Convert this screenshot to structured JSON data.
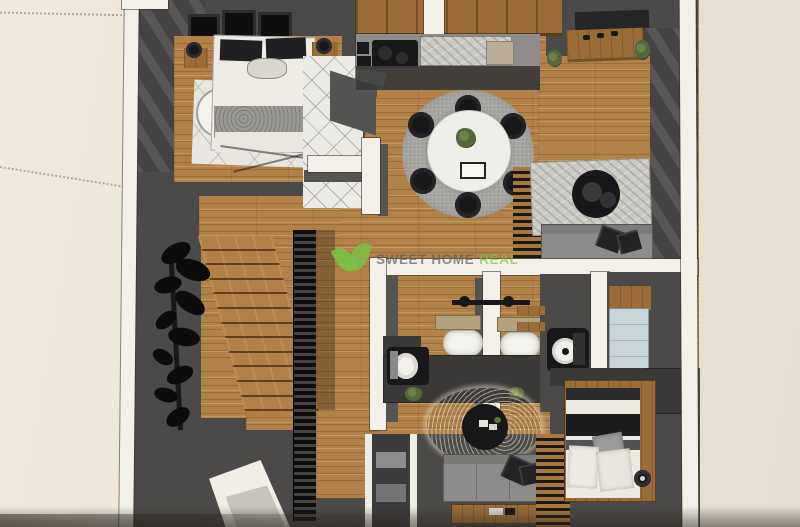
{
  "watermark": {
    "brand": "SWEET HOME",
    "brand_accent": "REAL",
    "logo_icon": "green-leaf-heart"
  },
  "colors": {
    "background": "#ebe4d6",
    "plan_wall_white": "#f3f0e9",
    "wood_floor": "#b28148",
    "wood_dark": "#9a6c38",
    "dark_surface": "#4b4a48",
    "darker_surface": "#3a3938",
    "black_furniture": "#18181a",
    "sofa_gray": "#8d8c8a",
    "rug_gray": "#a8a6a2",
    "marble_light": "#cccac4",
    "cream_rug": "#e9e0cd",
    "shower_blue": "#c5d5d8",
    "mat_tan": "#b3a17d",
    "plant_green": "#55683c",
    "brand_green": "#79c143",
    "watermark_text": "#5c5e5a"
  }
}
